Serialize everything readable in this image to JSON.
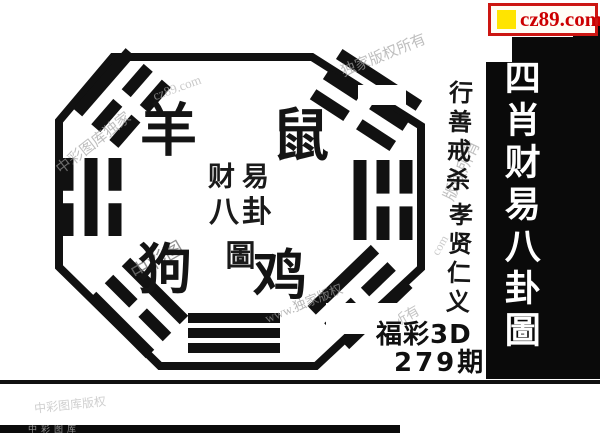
{
  "site_badge": {
    "text": "cz89.com",
    "icon": "yellow-square-icon",
    "colors": {
      "border": "#cc1612",
      "text": "#cc0000",
      "icon_bg": "#ffe400"
    }
  },
  "sidebar": {
    "title": "四肖财易八卦圖",
    "bg": "#0a0a0a",
    "text_color": "#ffffff"
  },
  "motto": {
    "group1": "行善戒杀",
    "group2": "孝贤仁义"
  },
  "bagua": {
    "center_title_line1": "财易",
    "center_title_line2": "八卦圖",
    "zodiac": [
      {
        "name": "sheep",
        "char": "羊",
        "position": "top-left"
      },
      {
        "name": "rat",
        "char": "鼠",
        "position": "top-right"
      },
      {
        "name": "dog",
        "char": "狗",
        "position": "bottom-left"
      },
      {
        "name": "rooster",
        "char": "鸡",
        "position": "bottom-right"
      }
    ],
    "trigrams": [
      {
        "position": "top-left-corner",
        "lines": [
          "solid",
          "broken",
          "broken"
        ]
      },
      {
        "position": "top-right-corner",
        "lines": [
          "solid",
          "broken",
          "broken"
        ]
      },
      {
        "position": "left-side",
        "lines": [
          "broken",
          "solid",
          "broken"
        ]
      },
      {
        "position": "right-side",
        "lines": [
          "broken",
          "broken",
          "solid"
        ]
      },
      {
        "position": "bottom-left-corner",
        "lines": [
          "solid",
          "broken",
          "solid"
        ]
      },
      {
        "position": "bottom-right-corner",
        "lines": [
          "solid",
          "broken",
          "solid"
        ]
      },
      {
        "position": "bottom-middle",
        "lines": [
          "solid",
          "solid",
          "solid"
        ]
      }
    ]
  },
  "issue": {
    "game": "福彩3D",
    "period": "279期"
  },
  "watermarks": [
    "中彩图库独家",
    "cz89.com",
    "独家版权所有",
    "版权所有",
    "中彩图",
    "www.独家版权",
    "所有",
    "中彩图库版权",
    "com"
  ],
  "footer": {
    "strip_text": "中彩图库"
  }
}
